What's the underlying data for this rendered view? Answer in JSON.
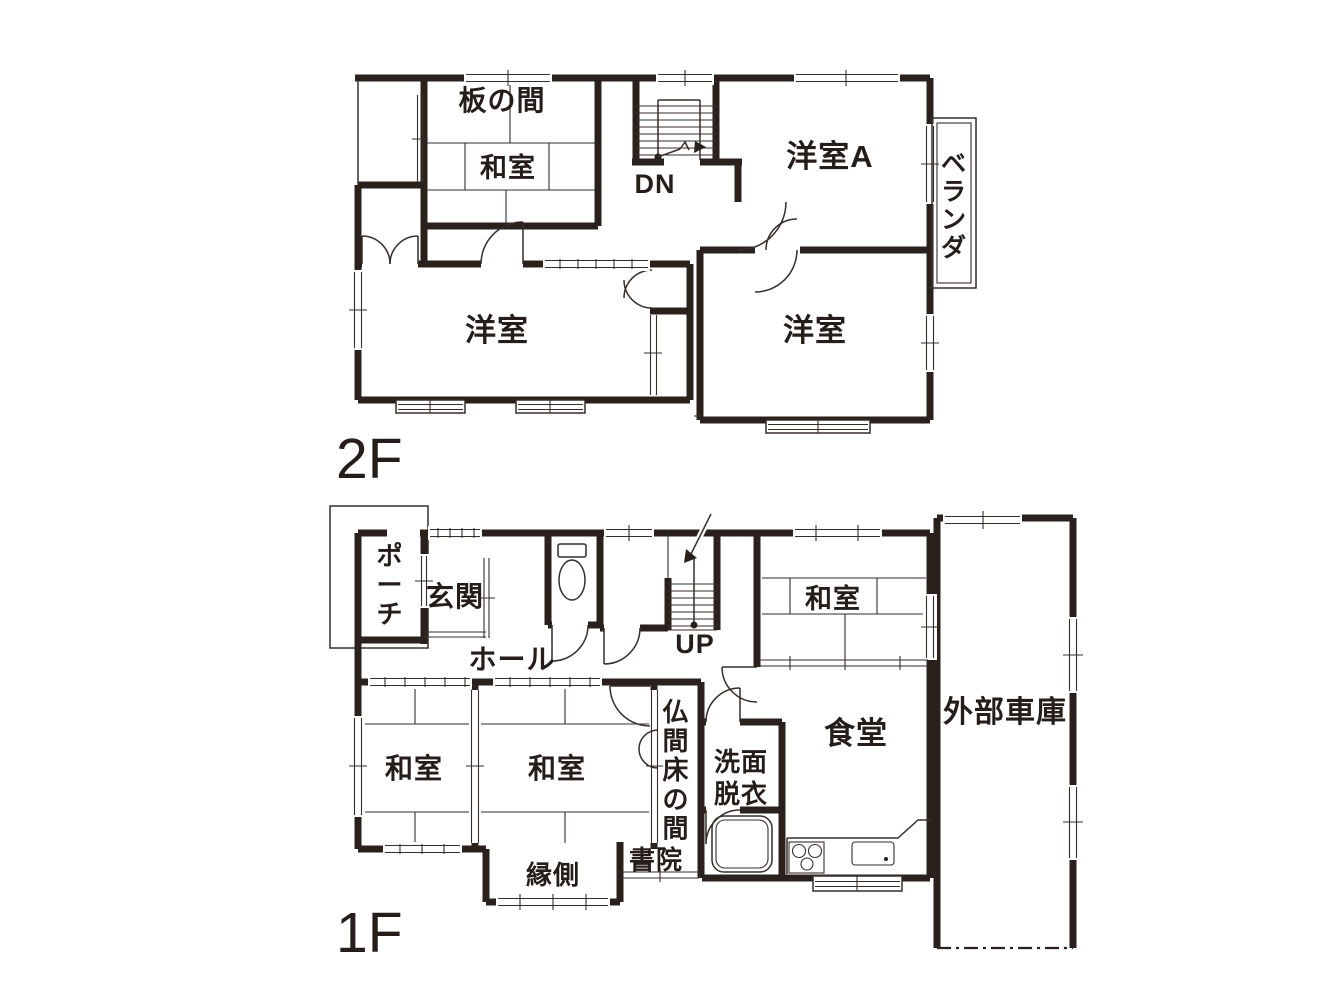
{
  "title": "住宅間取り図(1F・2F)",
  "colors": {
    "ink": "#2a211c",
    "thin_line": "#372e29",
    "background": "#ffffff"
  },
  "floor2": {
    "floor_label": "2F",
    "stair_label": "DN",
    "rooms": {
      "itanoma": "板の間",
      "washitsu": "和室",
      "youshitsu_a": "洋室A",
      "veranda": "ベランダ",
      "hall": "ホール",
      "youshitsu_west": "洋室",
      "youshitsu_east": "洋室"
    }
  },
  "floor1": {
    "floor_label": "1F",
    "stair_label": "UP",
    "rooms": {
      "porch": "ポーチ",
      "genkan": "玄関",
      "hall": "ホール",
      "washitsu_ne": "和室",
      "garage": "外部車庫",
      "dining": "食堂",
      "washroom_line1": "洗面",
      "washroom_line2": "脱衣",
      "washitsu_sw1": "和室",
      "washitsu_sw2": "和室",
      "butsuma_tokonoma": "仏間床の間",
      "shoin": "書院",
      "engawa": "縁側"
    }
  }
}
